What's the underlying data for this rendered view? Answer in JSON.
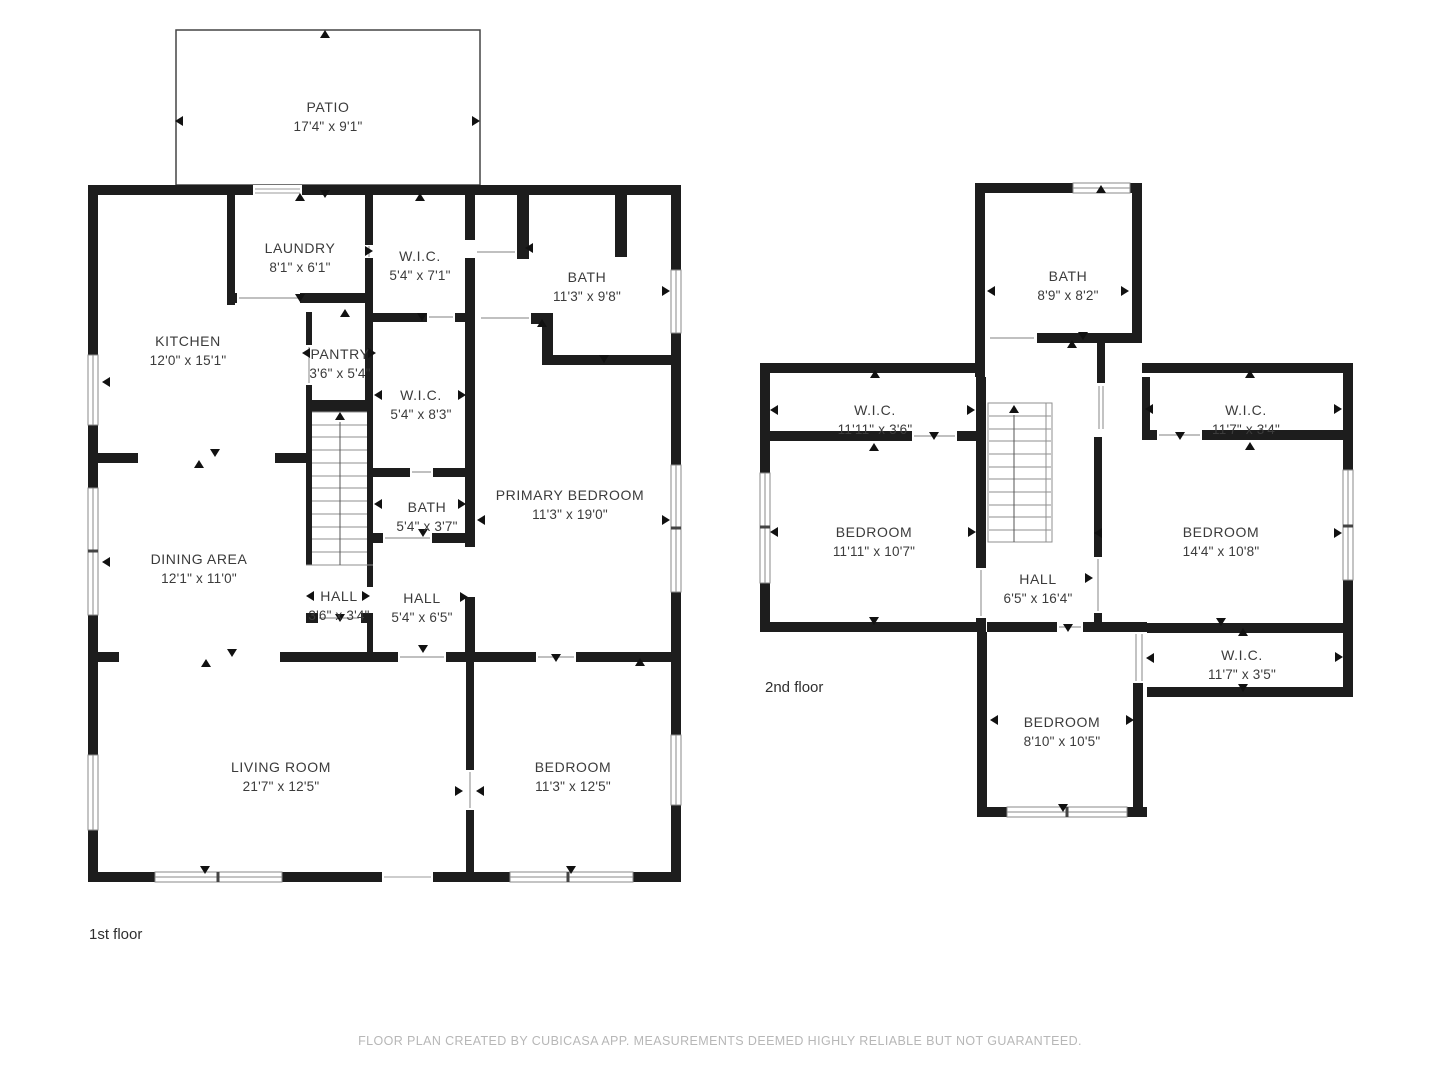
{
  "footer": {
    "text": "FLOOR PLAN CREATED BY CUBICASA APP. MEASUREMENTS DEEMED HIGHLY RELIABLE BUT NOT GUARANTEED."
  },
  "colors": {
    "wall": "#1d1d1d",
    "label_text": "#3b3b3b",
    "footer_text": "#b7b7b7",
    "background": "#ffffff"
  },
  "first_floor": {
    "label": "1st floor",
    "rooms": {
      "patio": {
        "name": "PATIO",
        "dims": "17'4\" x 9'1\""
      },
      "laundry": {
        "name": "LAUNDRY",
        "dims": "8'1\" x 6'1\""
      },
      "kitchen": {
        "name": "KITCHEN",
        "dims": "12'0\" x 15'1\""
      },
      "wic_top": {
        "name": "W.I.C.",
        "dims": "5'4\" x 7'1\""
      },
      "bath_main": {
        "name": "BATH",
        "dims": "11'3\" x 9'8\""
      },
      "pantry": {
        "name": "PANTRY",
        "dims": "3'6\" x 5'4\""
      },
      "wic_mid": {
        "name": "W.I.C.",
        "dims": "5'4\" x 8'3\""
      },
      "bath_small": {
        "name": "BATH",
        "dims": "5'4\" x 3'7\""
      },
      "primary_bedroom": {
        "name": "PRIMARY BEDROOM",
        "dims": "11'3\" x 19'0\""
      },
      "dining_area": {
        "name": "DINING AREA",
        "dims": "12'1\" x 11'0\""
      },
      "hall_small": {
        "name": "HALL",
        "dims": "3'6\" x 3'4\""
      },
      "hall_main": {
        "name": "HALL",
        "dims": "5'4\" x 6'5\""
      },
      "living_room": {
        "name": "LIVING ROOM",
        "dims": "21'7\" x 12'5\""
      },
      "bedroom": {
        "name": "BEDROOM",
        "dims": "11'3\" x 12'5\""
      }
    }
  },
  "second_floor": {
    "label": "2nd floor",
    "rooms": {
      "bath": {
        "name": "BATH",
        "dims": "8'9\" x 8'2\""
      },
      "wic_left": {
        "name": "W.I.C.",
        "dims": "11'11\" x 3'6\""
      },
      "wic_right_top": {
        "name": "W.I.C.",
        "dims": "11'7\" x 3'4\""
      },
      "bedroom_left": {
        "name": "BEDROOM",
        "dims": "11'11\" x 10'7\""
      },
      "bedroom_right": {
        "name": "BEDROOM",
        "dims": "14'4\" x 10'8\""
      },
      "hall": {
        "name": "HALL",
        "dims": "6'5\" x 16'4\""
      },
      "wic_right_bottom": {
        "name": "W.I.C.",
        "dims": "11'7\" x 3'5\""
      },
      "bedroom_bottom": {
        "name": "BEDROOM",
        "dims": "8'10\" x 10'5\""
      }
    }
  }
}
